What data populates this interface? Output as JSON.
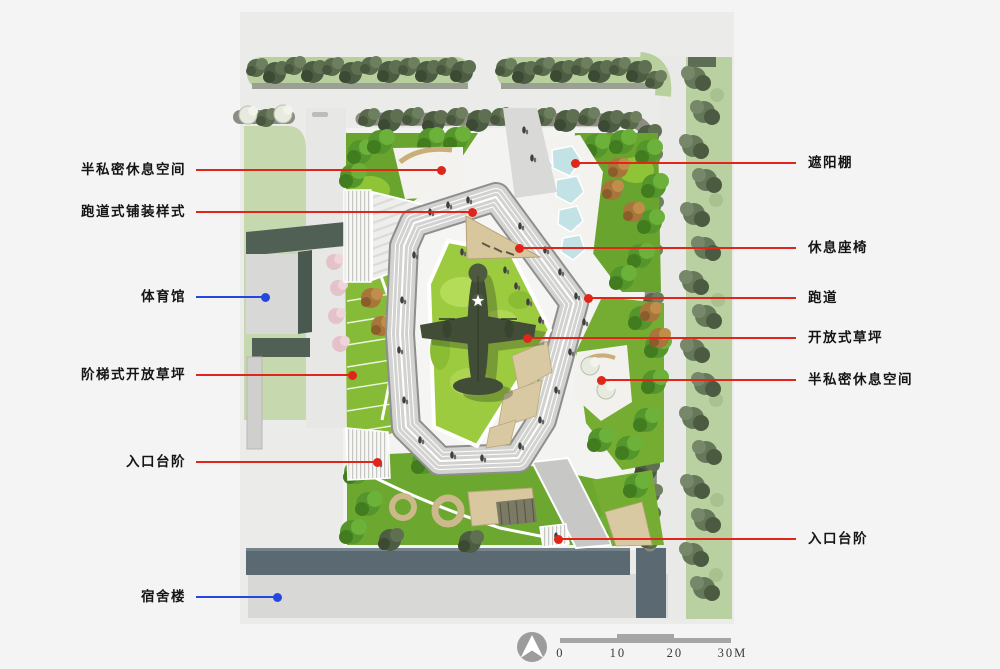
{
  "annotations": {
    "left": [
      {
        "text": "半私密休息空间",
        "color": "red"
      },
      {
        "text": "跑道式铺装样式",
        "color": "red"
      },
      {
        "text": "体育馆",
        "color": "blue"
      },
      {
        "text": "阶梯式开放草坪",
        "color": "red"
      },
      {
        "text": "入口台阶",
        "color": "red"
      },
      {
        "text": "宿舍楼",
        "color": "blue"
      }
    ],
    "right": [
      {
        "text": "遮阳棚",
        "color": "red"
      },
      {
        "text": "休息座椅",
        "color": "red"
      },
      {
        "text": "跑道",
        "color": "red"
      },
      {
        "text": "开放式草坪",
        "color": "red"
      },
      {
        "text": "半私密休息空间",
        "color": "red"
      },
      {
        "text": "入口台阶",
        "color": "red"
      }
    ]
  },
  "scale_bar": {
    "ticks": [
      "0",
      "10",
      "20",
      "30M"
    ]
  },
  "colors": {
    "leader_red": "#e0251b",
    "leader_blue": "#2547e0",
    "open_lawn": "#9ccb3f",
    "planting_green": "#69a52e",
    "green_belt": "#b9d0a1",
    "track_gray": "#d2d2d0",
    "plaza_white": "#f5f5f3",
    "gym_roof": "#506055",
    "dorm_slate": "#5b6a72",
    "canopy_blue": "#c3e2e6",
    "deck_tan": "#d8c69c"
  }
}
